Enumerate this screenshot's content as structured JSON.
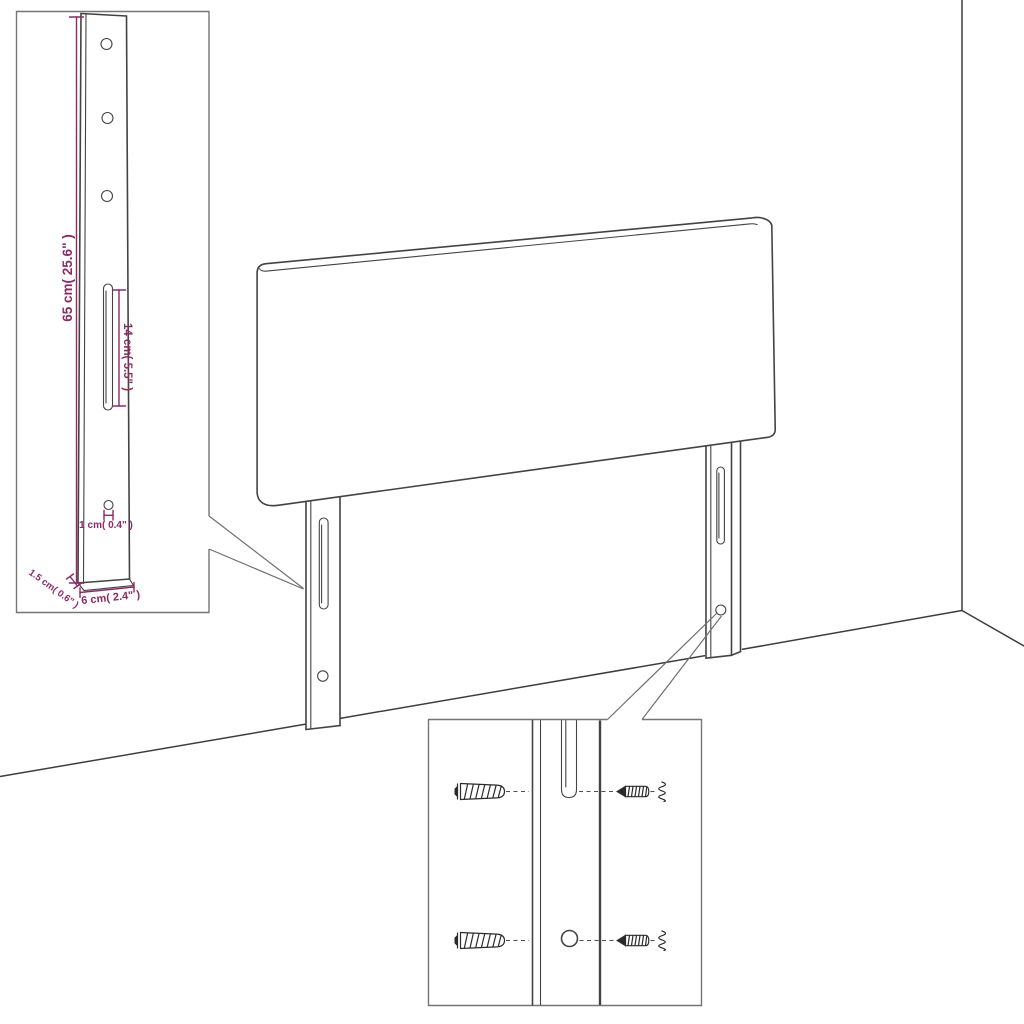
{
  "diagram": {
    "kind": "headboard wall-mount dimension diagram",
    "colors": {
      "background": "#ffffff",
      "product_line": "#434343",
      "dimension": "#8e2963",
      "callout_box_border": "#757575",
      "hardware_line": "#2b2b2b"
    },
    "dimension_labels": {
      "leg_height": "65 cm( 25.6\" )",
      "slot_length": "14 cm( 5.5\" )",
      "hole_diameter": "1 cm( 0.4\" )",
      "leg_thickness": "1.5 cm( 0.6\" )",
      "leg_width": "6 cm( 2.4\" )"
    }
  }
}
